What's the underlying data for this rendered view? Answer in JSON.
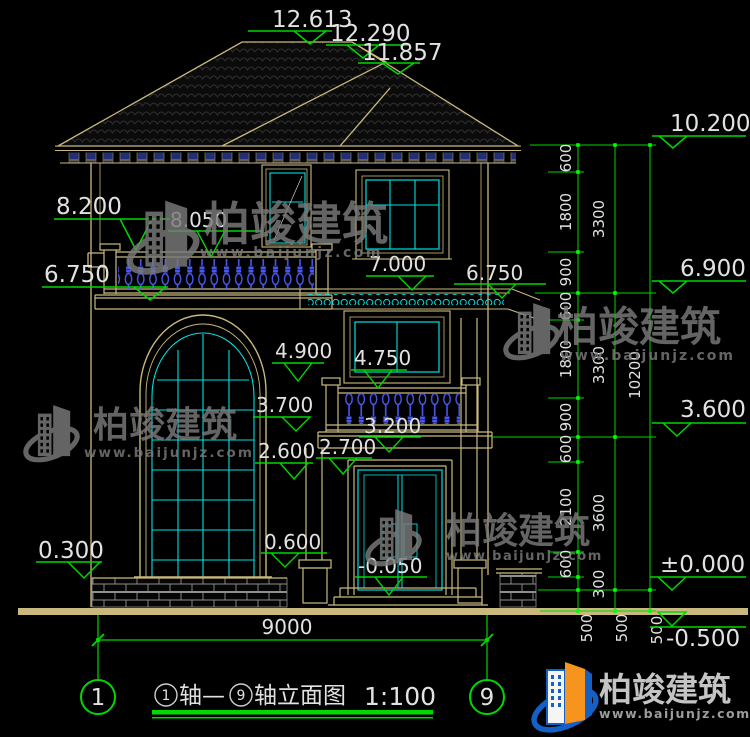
{
  "colors": {
    "background": "#000000",
    "dimension_green": "#00d800",
    "outline_tan": "#c9b97e",
    "glazing_cyan": "#00e0e0",
    "baluster_blue": "#4a58ef",
    "text_white": "#e2e2e2",
    "watermark_gray": "#7a7a7a",
    "logo_blue": "#1460c4",
    "logo_orange": "#f7941d"
  },
  "markers": {
    "top": [
      "12.613",
      "12.290",
      "11.857"
    ],
    "left": [
      "8.200",
      "6.750",
      "0.300"
    ],
    "inner": [
      "8.050",
      "7.000",
      "6.750",
      "4.900",
      "4.750",
      "3.700",
      "3.200",
      "2.700",
      "2.600",
      "0.600",
      "-0.050"
    ],
    "right": [
      "10.200",
      "6.900",
      "3.600",
      "±0.000",
      "-0.500"
    ]
  },
  "dimensions": {
    "bottom_width": "9000",
    "chain_col1": [
      "600",
      "1800",
      "900",
      "600",
      "1800",
      "900",
      "600",
      "2100",
      "600",
      "300",
      "500"
    ],
    "chain_col2": [
      "3300",
      "3300",
      "3600",
      "500"
    ],
    "chain_col3": [
      "10200",
      "500"
    ]
  },
  "title_block": {
    "axis_bubble_left": "1",
    "axis_bubble_right": "9",
    "axis_circle_start": "1",
    "axis_text_start": "轴—",
    "axis_circle_end": "9",
    "axis_text_end": "轴立面图",
    "scale": "1:100"
  },
  "watermark": {
    "brand": "柏竣建筑",
    "url": "www.baijunjz.com"
  }
}
